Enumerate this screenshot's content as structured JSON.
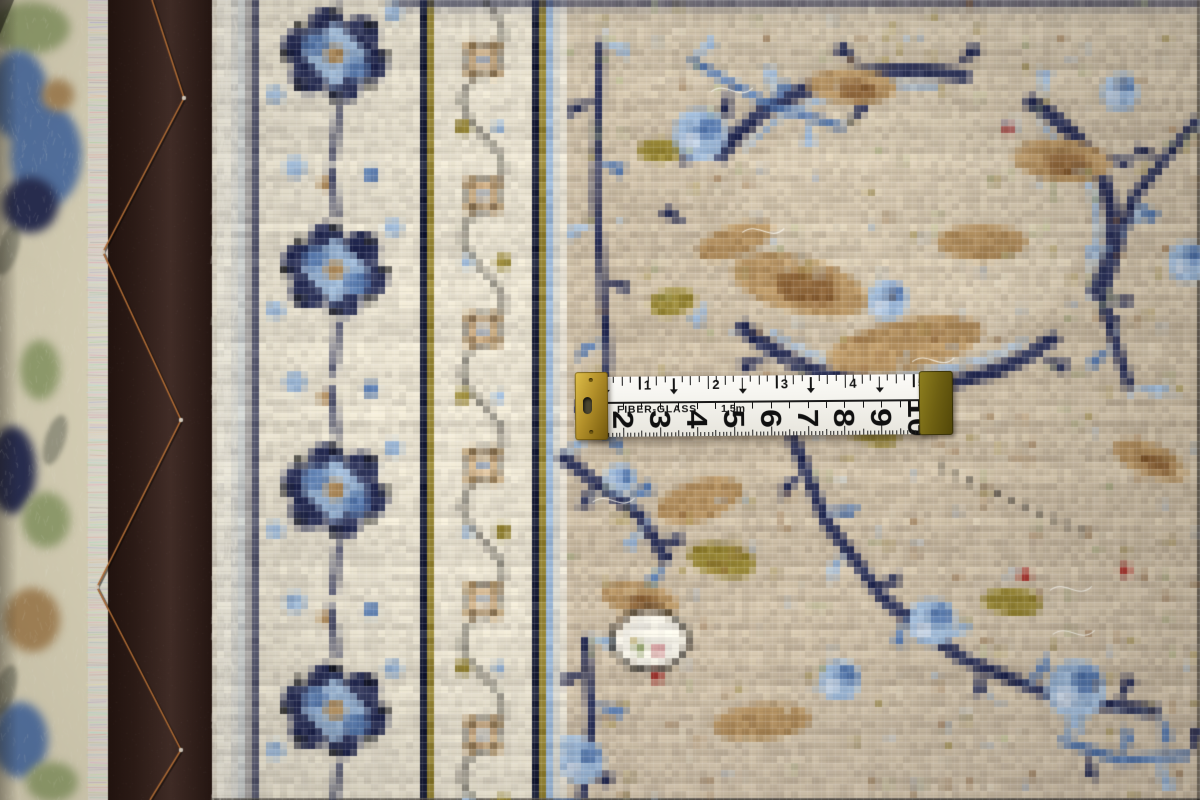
{
  "scene_title": "Back of a hand-knotted beige and blue Persian rug with a fiber-glass measuring tape",
  "tape": {
    "brand_label": "FIBER-GLASS",
    "length_label": "1.5m",
    "inch_numbers": [
      "1",
      "2",
      "3",
      "4",
      "5"
    ],
    "cm_numbers": [
      "2",
      "3",
      "4",
      "5",
      "6",
      "7",
      "8",
      "9",
      "10"
    ],
    "body_color": "#f6f5f0",
    "marking_color": "#141414",
    "left_clip_color": "#b3902a",
    "right_clip_color": "#6e6012"
  },
  "carpet": {
    "palette": {
      "field_bg": "#c9baa2",
      "field_bg_warm": "#cfc0ab",
      "cream": "#e5decc",
      "selvage": "#e9e5d8",
      "navy": "#2b3158",
      "navy_dark": "#1a1f38",
      "blue": "#5a7cb0",
      "light_blue": "#9cb7d6",
      "pale_blue": "#c4d1e2",
      "tan": "#b39060",
      "brown": "#8a6136",
      "olive": "#958434",
      "green": "#9eac78",
      "red": "#a83832",
      "white": "#efece2",
      "black": "#20201e",
      "pile_cream": "#e9e2c6",
      "fringe_white": "#f0ebdf",
      "leather_dark": "#2f1d18",
      "leather_mid": "#46302a",
      "stitch_copper": "#c0763b"
    },
    "layout_bands": {
      "pile_end": 92,
      "fringe_end": 108,
      "leather_end": 212,
      "selvage_end": 236,
      "border_end": 566
    },
    "bands": [
      {
        "x0": 236,
        "x1": 243,
        "color": "pale_blue"
      },
      {
        "x0": 243,
        "x1": 250,
        "color": "selvage"
      },
      {
        "x0": 250,
        "x1": 258,
        "color": "navy"
      },
      {
        "x0": 258,
        "x1": 420,
        "color": "cream"
      },
      {
        "x0": 420,
        "x1": 427,
        "color": "navy_dark"
      },
      {
        "x0": 427,
        "x1": 434,
        "color": "olive"
      },
      {
        "x0": 434,
        "x1": 532,
        "color": "cream"
      },
      {
        "x0": 532,
        "x1": 539,
        "color": "navy_dark"
      },
      {
        "x0": 539,
        "x1": 546,
        "color": "olive"
      },
      {
        "x0": 546,
        "x1": 556,
        "color": "light_blue"
      },
      {
        "x0": 556,
        "x1": 566,
        "color": "selvage"
      }
    ],
    "border_motif_centers_y": [
      55,
      270,
      490,
      710
    ],
    "rosette_centers_y": [
      60,
      195,
      330,
      465,
      600,
      735
    ],
    "stitch_vertices": [
      [
        152,
        0
      ],
      [
        184,
        98
      ],
      [
        103,
        252
      ],
      [
        181,
        420
      ],
      [
        97,
        587
      ],
      [
        181,
        750
      ],
      [
        150,
        800
      ]
    ],
    "pile_blobs": [
      [
        30,
        28,
        40,
        26,
        "green"
      ],
      [
        18,
        95,
        30,
        45,
        "blue"
      ],
      [
        46,
        155,
        36,
        52,
        "blue"
      ],
      [
        30,
        205,
        28,
        28,
        "navy"
      ],
      [
        58,
        95,
        16,
        16,
        "tan"
      ],
      [
        20,
        305,
        26,
        40,
        "pile_cream"
      ],
      [
        12,
        470,
        24,
        44,
        "navy"
      ],
      [
        46,
        520,
        24,
        28,
        "green"
      ],
      [
        32,
        620,
        28,
        32,
        "tan"
      ],
      [
        20,
        740,
        28,
        38,
        "blue"
      ],
      [
        52,
        782,
        26,
        20,
        "green"
      ],
      [
        40,
        370,
        20,
        30,
        "green"
      ]
    ],
    "field_ring": {
      "cx": 905,
      "cy": 228,
      "rx": 208,
      "ry": 158,
      "w": 14,
      "arcs": [
        [
          -2.7,
          -1.25
        ],
        [
          -0.95,
          0.45
        ],
        [
          0.75,
          2.5
        ]
      ]
    },
    "field_vines": [
      {
        "pts": [
          [
            690,
            60
          ],
          [
            770,
            105
          ],
          [
            845,
            128
          ]
        ],
        "w": 8,
        "color": "blue",
        "leaves": 5
      },
      {
        "pts": [
          [
            600,
            40
          ],
          [
            596,
            200
          ],
          [
            608,
            360
          ],
          [
            596,
            430
          ]
        ],
        "w": 8,
        "color": "navy",
        "leaves": 9
      },
      {
        "pts": [
          [
            560,
            455
          ],
          [
            640,
            515
          ],
          [
            668,
            562
          ]
        ],
        "w": 12,
        "color": "navy",
        "leaves": 6
      },
      {
        "pts": [
          [
            585,
            636
          ],
          [
            592,
            720
          ],
          [
            582,
            800
          ]
        ],
        "w": 9,
        "color": "navy",
        "leaves": 6
      },
      {
        "pts": [
          [
            790,
            430
          ],
          [
            825,
            520
          ],
          [
            885,
            600
          ],
          [
            962,
            658
          ],
          [
            1062,
            700
          ],
          [
            1160,
            712
          ]
        ],
        "w": 12,
        "color": "navy",
        "leaves": 12
      },
      {
        "pts": [
          [
            1198,
            118
          ],
          [
            1132,
            200
          ],
          [
            1102,
            300
          ],
          [
            1130,
            388
          ]
        ],
        "w": 10,
        "color": "navy",
        "leaves": 7
      },
      {
        "pts": [
          [
            940,
            468
          ],
          [
            1012,
            500
          ],
          [
            1092,
            536
          ]
        ],
        "w": 4,
        "color": "black",
        "dotted": true
      },
      {
        "pts": [
          [
            1060,
            740
          ],
          [
            1120,
            760
          ],
          [
            1190,
            755
          ]
        ],
        "w": 9,
        "color": "blue",
        "leaves": 5
      }
    ],
    "tan_patches": [
      [
        800,
        285,
        70,
        28,
        0.25
      ],
      [
        905,
        345,
        80,
        26,
        -0.2
      ],
      [
        1062,
        160,
        50,
        22,
        0.1
      ],
      [
        700,
        500,
        45,
        20,
        -0.3
      ],
      [
        640,
        600,
        40,
        17,
        0.2
      ],
      [
        982,
        242,
        45,
        18,
        0
      ],
      [
        1150,
        460,
        40,
        16,
        0.4
      ],
      [
        762,
        722,
        50,
        18,
        -0.1
      ],
      [
        852,
        86,
        46,
        18,
        0.05
      ],
      [
        735,
        240,
        40,
        16,
        -0.35
      ]
    ],
    "olive_patches": [
      [
        722,
        560,
        34,
        16,
        0.2
      ],
      [
        672,
        302,
        24,
        13,
        -0.2
      ],
      [
        1012,
        602,
        30,
        14,
        0.1
      ],
      [
        870,
        430,
        30,
        13,
        0.3
      ],
      [
        660,
        150,
        22,
        12,
        0
      ]
    ],
    "light_blue_clusters": [
      [
        700,
        135,
        26
      ],
      [
        888,
        300,
        20
      ],
      [
        1076,
        690,
        30
      ],
      [
        932,
        622,
        24
      ],
      [
        582,
        762,
        22
      ],
      [
        1188,
        262,
        20
      ],
      [
        1120,
        92,
        18
      ],
      [
        620,
        480,
        16
      ],
      [
        840,
        680,
        20
      ]
    ],
    "white_motifs": [
      [
        650,
        640,
        38,
        30
      ]
    ],
    "red_dots": [
      [
        1008,
        128
      ],
      [
        1125,
        570
      ],
      [
        657,
        677
      ],
      [
        1025,
        575
      ]
    ]
  }
}
